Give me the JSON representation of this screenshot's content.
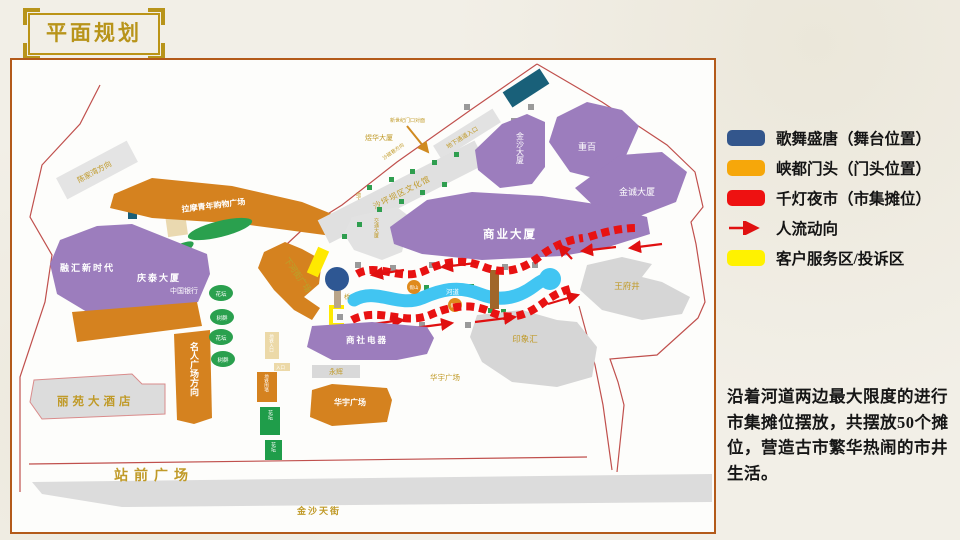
{
  "title": "平面规划",
  "legend": {
    "items": [
      {
        "label": "歌舞盛唐（舞台位置）",
        "color": "#33568c",
        "type": "swatch"
      },
      {
        "label": "峡都门头（门头位置）",
        "color": "#f6a70a",
        "type": "swatch"
      },
      {
        "label": "千灯夜市（市集摊位）",
        "color": "#ee1111",
        "type": "swatch"
      },
      {
        "label": "人流动向",
        "color": "#e01010",
        "type": "arrow"
      },
      {
        "label": "客户服务区/投诉区",
        "color": "#fff200",
        "type": "swatch"
      }
    ]
  },
  "description": "沿着河道两边最大限度的进行市集摊位摆放，共摆放50个摊位，营造古市繁华热闹的市井生活。",
  "colors": {
    "building_purple": "#9c7dbd",
    "building_orange": "#d5821f",
    "building_gray": "#dcdcdc",
    "river_blue": "#41c5f2",
    "stage_blue": "#2e5793",
    "stall_red": "#e81212",
    "service_yellow": "#ffe900",
    "green": "#2aa04e",
    "gold_text": "#c09a28",
    "boundary_red": "#c0504d"
  },
  "map": {
    "labels": {
      "chenjiawan": "陈家湾方向",
      "sanjiaobei": "三角碑",
      "lamo": "拉摩青年购物广场",
      "yuhua": "煜华大厦",
      "xinshiji": "新世纪门口对面",
      "shacixiang": "沙磁巷方向",
      "parking_entrance": "地下停车场入口",
      "passage_entrance": "地下通道入口",
      "wenhuaguan": "沙坪坝区文化馆",
      "jiaotong": "交通大厦",
      "jinsha": "金沙大厦",
      "chongbai": "重百",
      "jincheng": "金诚大厦",
      "shangye": "商业大厦",
      "ronghui": "融汇新时代",
      "qingtai": "庆泰大厦",
      "bank": "中国银行",
      "mingren": "名人广场方向",
      "huatan": "花坛",
      "shuqun": "树群",
      "xiahejie": "下河街广场",
      "qiao": "桥",
      "hedao": "河道",
      "jiashan": "假山",
      "wangfujing": "王府井",
      "yinxianghui": "印象汇",
      "shangshe": "商社电器",
      "yonghui": "永辉",
      "huayu": "华宇广场",
      "liyuan": "丽苑大酒店",
      "zhanqian": "站前广场",
      "jinshatianjie": "金沙天街",
      "metro_entrance": "地铁入口",
      "entrance": "入口",
      "metro_wall": "地铁围墙"
    }
  }
}
